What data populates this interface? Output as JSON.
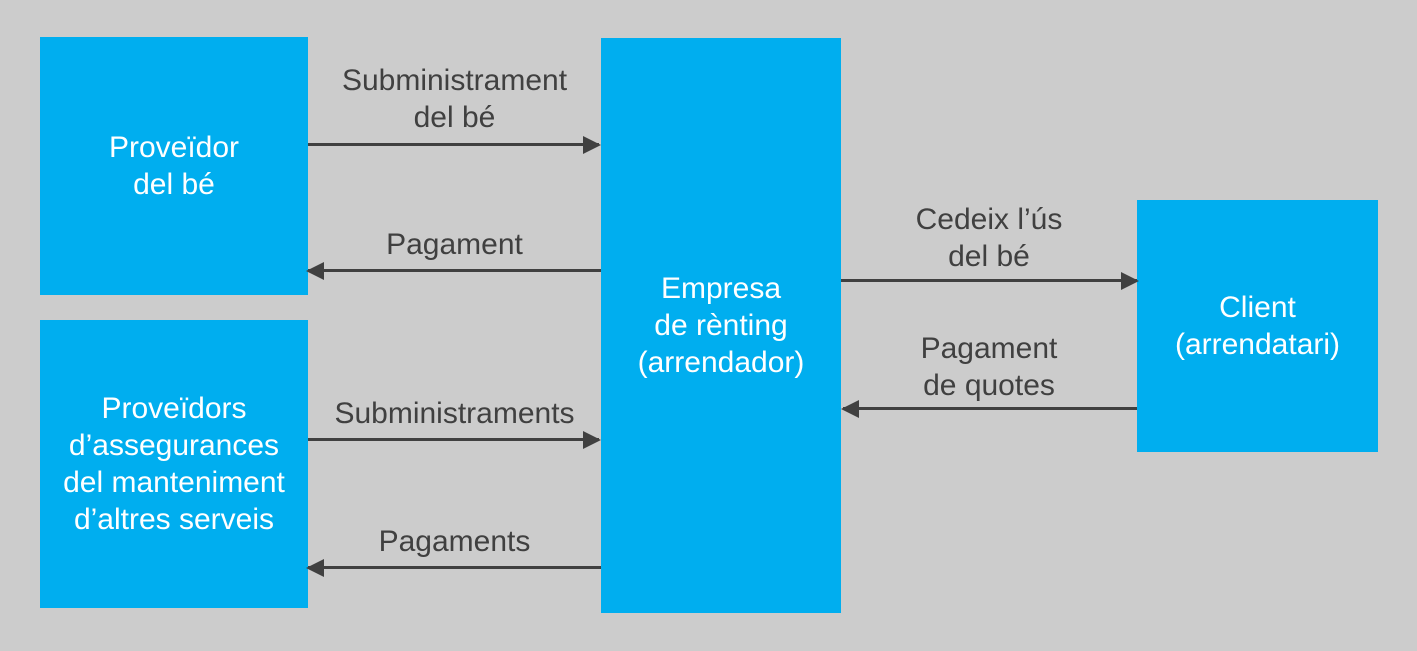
{
  "diagram": {
    "colors": {
      "background": "#cccccc",
      "node_fill": "#00aeef",
      "node_text": "#ffffff",
      "line_color": "#404040"
    },
    "nodes": {
      "provider_good": {
        "lines": [
          "Proveïdor",
          "del bé"
        ]
      },
      "provider_services": {
        "lines": [
          "Proveïdors",
          "d’assegurances",
          "del manteniment",
          "d’altres serveis"
        ]
      },
      "renting_company": {
        "lines": [
          "Empresa",
          "de rènting",
          "(arrendador)"
        ]
      },
      "client": {
        "lines": [
          "Client",
          "(arrendatari)"
        ]
      }
    },
    "flows": {
      "supply_good": {
        "lines": [
          "Subministrament",
          "del bé"
        ],
        "direction": "right"
      },
      "payment_good": {
        "lines": [
          "Pagament"
        ],
        "direction": "left"
      },
      "supplies": {
        "lines": [
          "Subministraments"
        ],
        "direction": "right"
      },
      "payments": {
        "lines": [
          "Pagaments"
        ],
        "direction": "left"
      },
      "cede_use": {
        "lines": [
          "Cedeix l’ús",
          "del bé"
        ],
        "direction": "right"
      },
      "fee_payment": {
        "lines": [
          "Pagament",
          "de quotes"
        ],
        "direction": "left"
      }
    }
  }
}
